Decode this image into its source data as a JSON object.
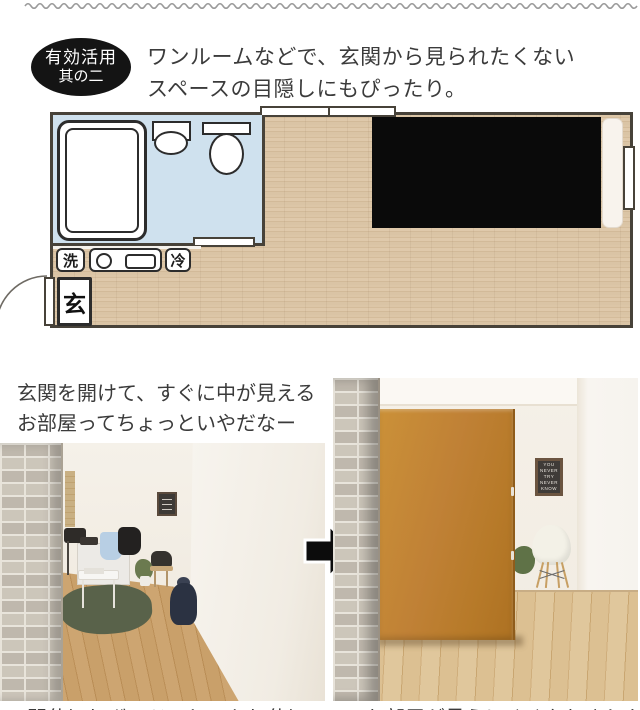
{
  "badge": {
    "line1": "有効活用",
    "line2": "其の二"
  },
  "headline": {
    "line1": "ワンルームなどで、玄関から見られたくない",
    "line2": "スペースの目隠しにもぴったり。"
  },
  "floorplan": {
    "labels": {
      "washer": "洗",
      "fridge": "冷",
      "entrance": "玄"
    },
    "colors": {
      "wall": "#474239",
      "wood_floor": "#d9c3a4",
      "bath_area": "#cfe1ee",
      "hidden_space": "#0a0a0a",
      "fixtures": "#ffffff"
    }
  },
  "before_caption": {
    "line1": "玄関を開けて、すぐに中が見える",
    "line2": "お部屋ってちょっといやだなー"
  },
  "after_caption": {
    "text": "間仕切りボードでしっかり仕切って、お部屋が見えにくくなりました"
  },
  "after_photo": {
    "poster_lines": [
      "YOU",
      "NEVER",
      "TRY",
      "NEVER",
      "KNOW"
    ],
    "board_color": "#c08136"
  },
  "decor": {
    "squiggle_color": "#9b9b9b",
    "badge_bg": "#141414",
    "arrow_color": "#0c0c0c"
  }
}
